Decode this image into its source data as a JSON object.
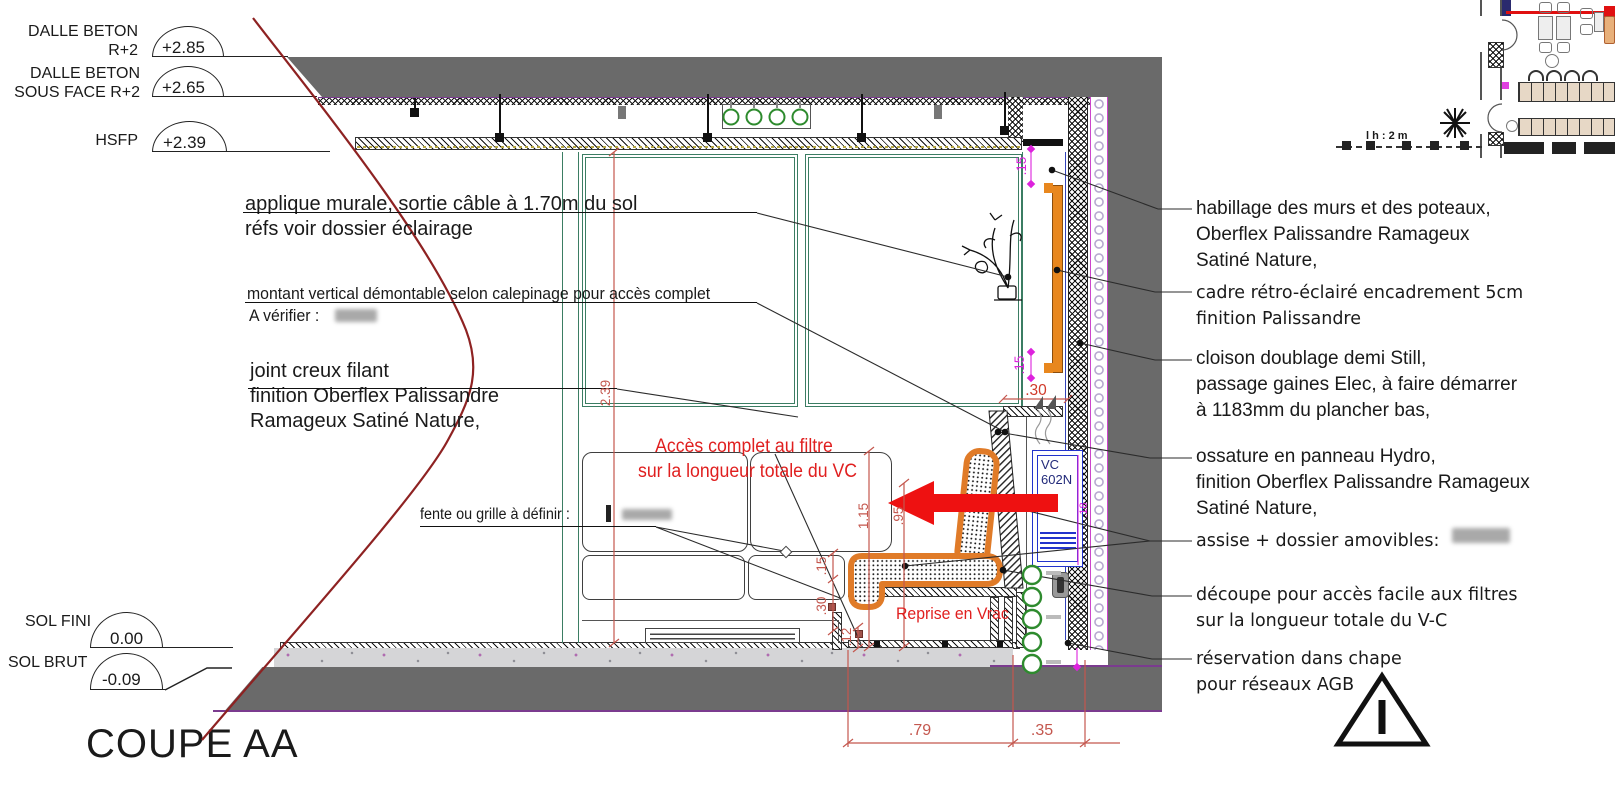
{
  "title": "COUPE AA",
  "colors": {
    "wall_gray": "#6a6a6a",
    "panel_teal": "#3b7d63",
    "dim_red": "#c4574e",
    "magenta": "#dd22dd",
    "cushion_orange": "#e07b28",
    "note_red": "#e01f1f",
    "vc_blue": "#2233cc",
    "pipe_green": "#2e8b2e",
    "break_line_red": "#8e2222"
  },
  "levels": [
    {
      "line1": "DALLE BETON",
      "line2": "R+2",
      "value": "+2.85"
    },
    {
      "line1": "DALLE BETON",
      "line2": "SOUS FACE R+2",
      "value": "+2.65"
    },
    {
      "line2": "HSFP",
      "value": "+2.39"
    }
  ],
  "floor_levels": [
    {
      "label": "SOL FINI",
      "value": "0.00"
    },
    {
      "label": "SOL BRUT",
      "value": "-0.09"
    }
  ],
  "notes_left": [
    {
      "line1": "applique murale, sortie câble à 1.70m du sol",
      "line2": "réfs voir dossier éclairage"
    },
    {
      "line1": "montant vertical démontable selon calepinage pour accès complet",
      "line2": "A vérifier :"
    },
    {
      "line1": "joint creux filant",
      "line2": "finition Oberflex Palissandre",
      "line3": "Ramageux Satiné Nature,"
    },
    {
      "line1": "fente ou grille à définir :"
    }
  ],
  "notes_right": [
    {
      "line1": "habillage des murs et des poteaux,",
      "line2": "Oberflex Palissandre Ramageux",
      "line3": "Satiné Nature,"
    },
    {
      "line1": "cadre rétro-éclairé encadrement 5cm",
      "line2": "finition Palissandre"
    },
    {
      "line1": "cloison doublage demi  Still,",
      "line2": "passage gaines Elec, à faire démarrer",
      "line3": "à 1183mm du plancher bas,"
    },
    {
      "line1": "ossature en panneau Hydro,",
      "line2": "finition Oberflex Palissandre Ramageux",
      "line3": "Satiné Nature,"
    },
    {
      "line1": "assise + dossier amovibles:"
    },
    {
      "line1": "découpe pour accès facile aux filtres",
      "line2": "sur la longueur totale du V-C"
    },
    {
      "line1": "réservation  dans chape",
      "line2": "pour réseaux AGB"
    }
  ],
  "notes_red": {
    "filter_access_line1": "Accès complet au filtre",
    "filter_access_line2": "sur la longueur totale du VC",
    "reprise": "Reprise en Vrac"
  },
  "vc_unit": {
    "line1": "VC",
    "line2": "602N"
  },
  "dimensions": {
    "panel_height": "2.39",
    "backrest_height": "1.15",
    "seat_height": ".95",
    "slot_gap": ".15",
    "base_height": ".30",
    "plinth_height": ".12",
    "bench_depth": ".79",
    "wall_offset": ".35",
    "ceiling_gap": ".15",
    "niche_gap": ".15",
    "niche_depth": ".30",
    "vc_width": ".18"
  },
  "plan_inset": {
    "scale_note": "l   h : 2 m"
  }
}
